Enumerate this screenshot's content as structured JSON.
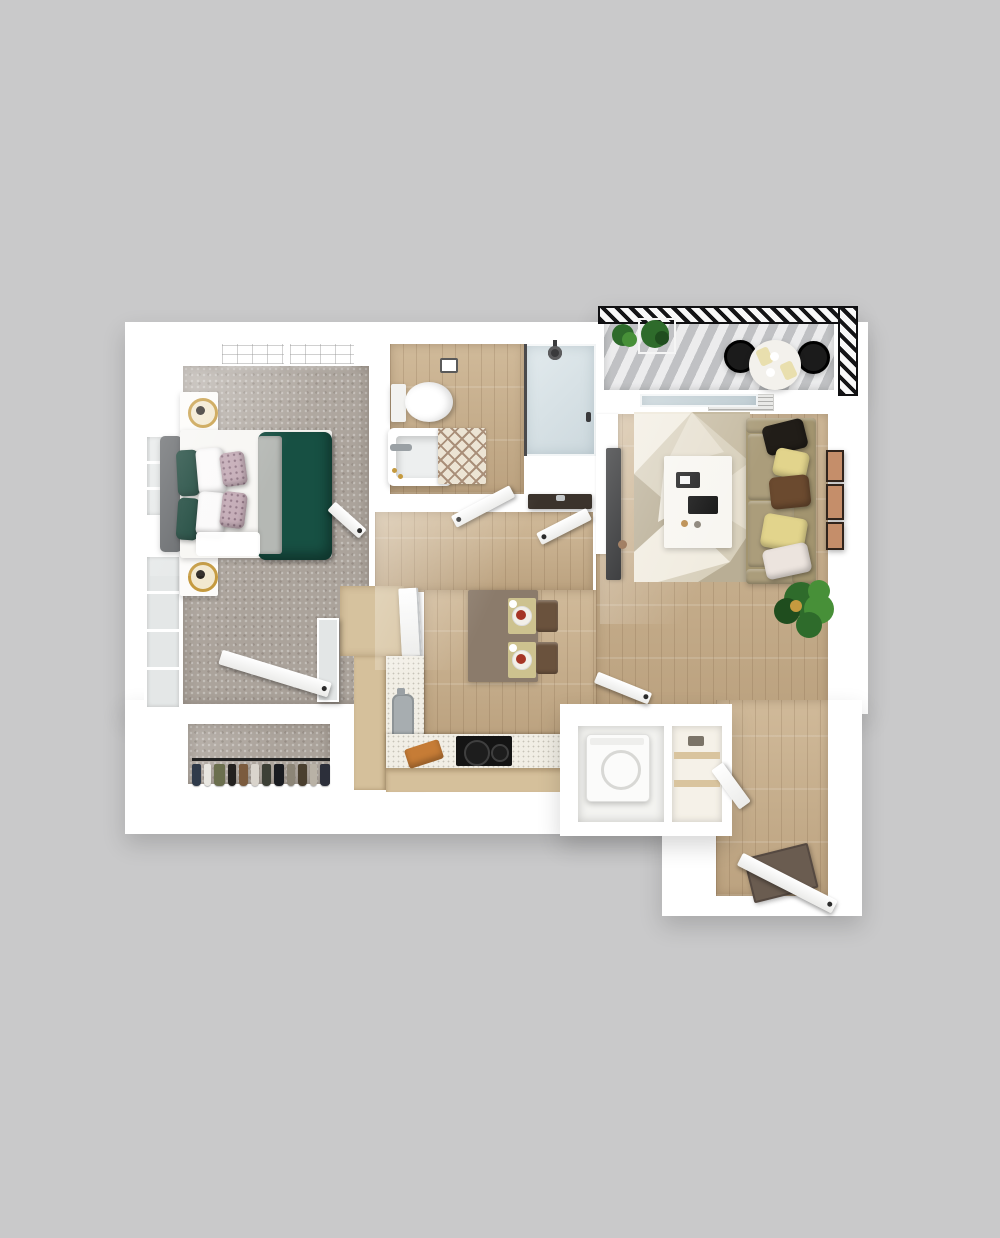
{
  "scene": {
    "type": "3d-floor-plan-render",
    "units": "one-bedroom one-bath apartment with balcony",
    "rooms": [
      {
        "id": "bedroom",
        "floor": "carpet",
        "furniture": [
          "bed",
          "nightstand",
          "nightstand",
          "table-lamp",
          "table-lamp",
          "mirror",
          "ceiling-lights",
          "windows"
        ]
      },
      {
        "id": "bathroom",
        "floor": "wood",
        "furniture": [
          "toilet",
          "bathtub",
          "bath-rug",
          "shower",
          "vanity-sink",
          "toilet-paper-holder"
        ]
      },
      {
        "id": "walk-in-closet",
        "floor": "carpet",
        "furniture": [
          "clothes-rod",
          "hanging-clothes"
        ]
      },
      {
        "id": "hallway",
        "floor": "wood",
        "furniture": []
      },
      {
        "id": "kitchen",
        "floor": "wood",
        "furniture": [
          "pantry",
          "sink",
          "cooktop",
          "counter",
          "cutting-board",
          "dining-table",
          "chair",
          "chair",
          "place-setting",
          "place-setting"
        ]
      },
      {
        "id": "laundry-closet",
        "floor": "wood",
        "furniture": [
          "washer",
          "storage-shelves"
        ]
      },
      {
        "id": "living-room",
        "floor": "wood",
        "furniture": [
          "sofa",
          "throw-pillows",
          "area-rug",
          "coffee-table",
          "tv",
          "wall-frames",
          "potted-plant",
          "ceiling-vent",
          "sliding-glass-door"
        ]
      },
      {
        "id": "entry",
        "floor": "wood",
        "furniture": [
          "front-door",
          "doormat"
        ]
      },
      {
        "id": "balcony",
        "floor": "deck",
        "furniture": [
          "railing",
          "round-table",
          "chair",
          "chair",
          "planter-plants",
          "place-setting",
          "place-setting"
        ]
      }
    ]
  },
  "palette": {
    "background": "#c9c9ca",
    "wall": "#ffffff",
    "carpet": "#aba39b",
    "wood": "#cbb28e",
    "deck": "#d4d5d7",
    "duvet_green": "#175043",
    "pillow_green": "#123f33",
    "accent_pillow": "#c3aab5",
    "blanket_gray": "#b5b8b4",
    "headboard": "#5d6063",
    "mattress": "#f7f6f3",
    "nightstand": "#fcfbf9",
    "lamp_gold": "#c59a3f",
    "lamp_dark": "#2a2520",
    "mirror": "#e3e6e6",
    "tub_inner": "#edefef",
    "bath_rug": "#ece4d4",
    "vanity_counter": "#3b332c",
    "sofa": "#a2946f",
    "sofa_cushion": "#ab9d7b",
    "pillow_black": "#211d18",
    "pillow_yellow": "#e2d48c",
    "pillow_brown": "#6b4a2f",
    "pillow_white": "#ece4de",
    "coffee_table": "#f8f6f1",
    "tv": "#17181a",
    "frame": "#31241c",
    "frame_inner": "#c58e6a",
    "plant": "#2e6b2b",
    "plant_light": "#479038",
    "plant_dark": "#1f4d1e",
    "dining_table": "#8b7b6b",
    "chair_brown": "#6a523d",
    "placemat": "#cdc28f",
    "plate_food": "#a63526",
    "counter": "#f1eee5",
    "cabinet": "#d5c09b",
    "pantry_floor": "#d6c29e",
    "sink_gray": "#a7adb0",
    "cooktop": "#141414",
    "cutting_board": "#c67c36",
    "washer": "#fbfbfa",
    "shelf_wood": "#d9c49e",
    "doormat": "#6a5c50",
    "balcony_chair": "#1b1b1b",
    "balcony_table": "#f3f1ec",
    "table_setting": "#e9dfae"
  },
  "closet": {
    "garments": [
      {
        "color": "#2f3a4a",
        "w": 10
      },
      {
        "color": "#e8e6e0",
        "w": 8
      },
      {
        "color": "#6b6f4e",
        "w": 12
      },
      {
        "color": "#23211f",
        "w": 9
      },
      {
        "color": "#7b5b3e",
        "w": 11
      },
      {
        "color": "#d9d4cc",
        "w": 8
      },
      {
        "color": "#3c3f35",
        "w": 10
      },
      {
        "color": "#191b20",
        "w": 12
      },
      {
        "color": "#8c8577",
        "w": 9
      },
      {
        "color": "#4a3f2f",
        "w": 10
      },
      {
        "color": "#b9b2a6",
        "w": 8
      },
      {
        "color": "#2c2f3a",
        "w": 11
      }
    ]
  }
}
